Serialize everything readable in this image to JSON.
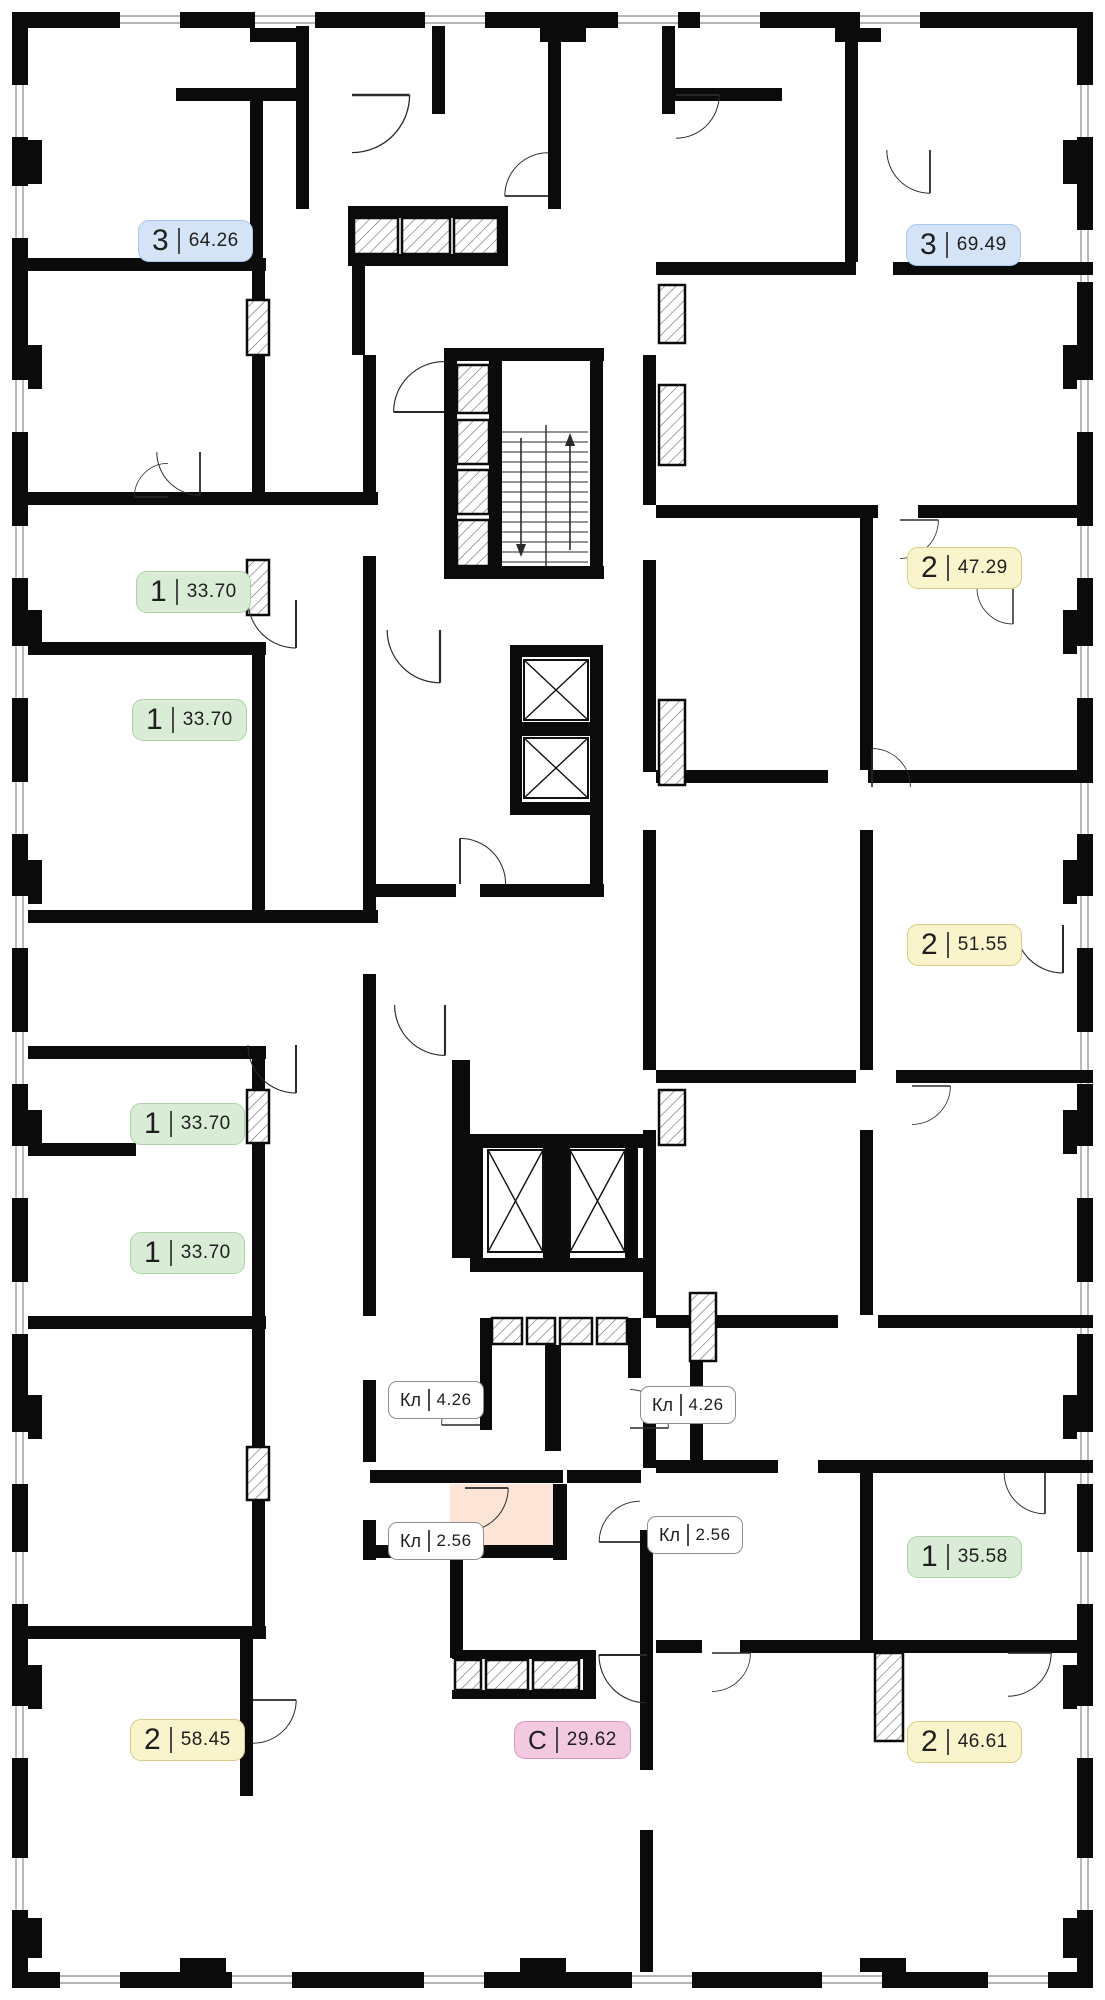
{
  "page": {
    "kind": "residential floor plan"
  },
  "units": [
    {
      "type": "3",
      "area": "64.26",
      "badge_color": "blue",
      "location": "top-left"
    },
    {
      "type": "3",
      "area": "69.49",
      "badge_color": "blue",
      "location": "top-right"
    },
    {
      "type": "1",
      "area": "33.70",
      "badge_color": "green",
      "location": "left-1"
    },
    {
      "type": "1",
      "area": "33.70",
      "badge_color": "green",
      "location": "left-2"
    },
    {
      "type": "1",
      "area": "33.70",
      "badge_color": "green",
      "location": "left-3"
    },
    {
      "type": "1",
      "area": "33.70",
      "badge_color": "green",
      "location": "left-4"
    },
    {
      "type": "2",
      "area": "47.29",
      "badge_color": "yellow",
      "location": "right-1"
    },
    {
      "type": "2",
      "area": "51.55",
      "badge_color": "yellow",
      "location": "right-2"
    },
    {
      "type": "1",
      "area": "35.58",
      "badge_color": "green",
      "location": "right-3"
    },
    {
      "type": "2",
      "area": "58.45",
      "badge_color": "yellow",
      "location": "bottom-left"
    },
    {
      "type": "С",
      "area": "29.62",
      "badge_color": "pink",
      "location": "bottom-center"
    },
    {
      "type": "2",
      "area": "46.61",
      "badge_color": "yellow",
      "location": "bottom-right"
    }
  ],
  "closets": [
    {
      "type": "Кл",
      "area": "4.26",
      "location": "core-left"
    },
    {
      "type": "Кл",
      "area": "4.26",
      "location": "core-right"
    },
    {
      "type": "Кл",
      "area": "2.56",
      "location": "core-lower-left"
    },
    {
      "type": "Кл",
      "area": "2.56",
      "location": "core-lower-right"
    }
  ],
  "colors": {
    "badge_blue": "#d4e4f6",
    "badge_green": "#d9edd6",
    "badge_yellow": "#faf4cd",
    "badge_pink": "#f3c9e1",
    "closet_highlight": "#fce4d6",
    "walls": "#0b0b0b"
  }
}
